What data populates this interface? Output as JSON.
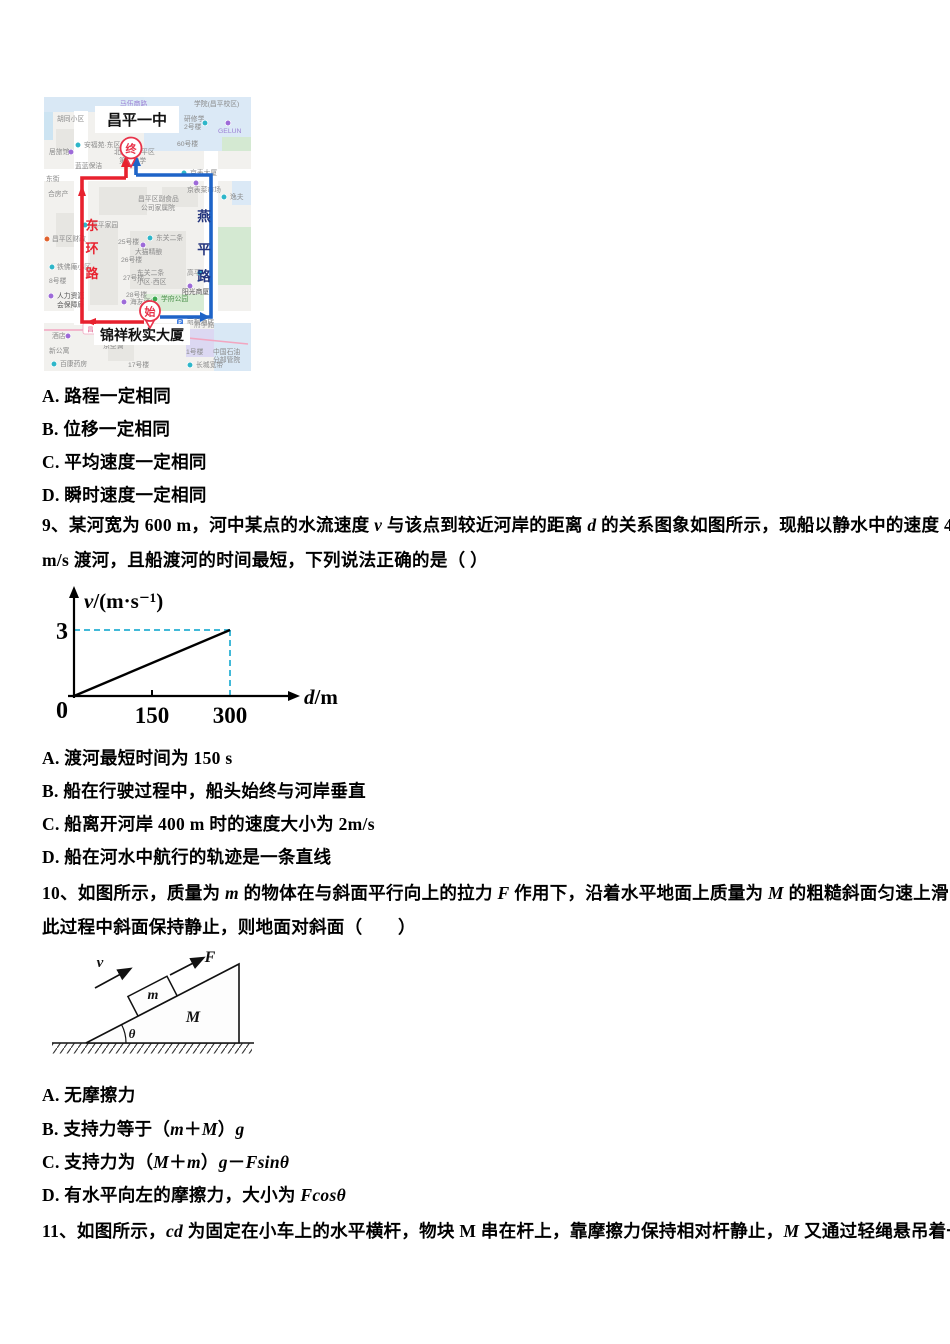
{
  "q8": {
    "options": [
      "A. 路程一定相同",
      "B. 位移一定相同",
      "C. 平均速度一定相同",
      "D. 瞬时速度一定相同"
    ]
  },
  "q9": {
    "stem": [
      [
        {
          "t": "9、某河宽为 600 m，河中某点的水流速度 "
        },
        {
          "t": "v",
          "i": true
        },
        {
          "t": " 与该点到较近河岸的距离 "
        },
        {
          "t": "d",
          "i": true
        },
        {
          "t": " 的关系图象如图所示，现船以静水中的速度 4"
        }
      ],
      [
        {
          "t": "m/s 渡河，且船渡河的时间最短，下列说法正确的是（ ）"
        }
      ]
    ],
    "options": [
      "A. 渡河最短时间为 150 s",
      "B. 船在行驶过程中，船头始终与河岸垂直",
      "C. 船离开河岸 400 m 时的速度大小为 2m/s",
      "D. 船在河水中航行的轨迹是一条直线"
    ]
  },
  "chart_data": {
    "type": "line",
    "title": "",
    "xlabel": "d/m",
    "ylabel": "v/(m·s⁻¹)",
    "xlabel_var": "d",
    "xlabel_rest": "/m",
    "ylabel_var": "v",
    "ylabel_rest": "/(m·s⁻¹)",
    "x": [
      0,
      300
    ],
    "y": [
      0,
      3
    ],
    "xticks": [
      150,
      300
    ],
    "yticks": [
      3
    ],
    "origin_label": "0",
    "xlim": [
      0,
      330
    ],
    "ylim": [
      0,
      3.6
    ],
    "dashed_guides": {
      "y": 3,
      "x": 300
    },
    "line_color": "#000000",
    "guide_color": "#41b9d8",
    "legend": [],
    "grid": false
  },
  "q10": {
    "stem": [
      [
        {
          "t": "10、如图所示，质量为 "
        },
        {
          "t": "m",
          "i": true
        },
        {
          "t": " 的物体在与斜面平行向上的拉力 "
        },
        {
          "t": "F",
          "i": true
        },
        {
          "t": " 作用下，沿着水平地面上质量为 "
        },
        {
          "t": "M",
          "i": true
        },
        {
          "t": " 的粗糙斜面匀速上滑，在"
        }
      ],
      [
        {
          "t": "此过程中斜面保持静止，则地面对斜面（　　）"
        }
      ]
    ],
    "options": [
      [
        {
          "t": "A. 无摩擦力"
        }
      ],
      [
        {
          "t": "B. 支持力等于（"
        },
        {
          "t": "m",
          "i": true
        },
        {
          "t": "＋"
        },
        {
          "t": "M",
          "i": true
        },
        {
          "t": "）"
        },
        {
          "t": "g",
          "i": true
        }
      ],
      [
        {
          "t": "C. 支持力为（"
        },
        {
          "t": "M",
          "i": true
        },
        {
          "t": "＋"
        },
        {
          "t": "m",
          "i": true
        },
        {
          "t": "）"
        },
        {
          "t": "g",
          "i": true
        },
        {
          "t": "－"
        },
        {
          "t": "Fsinθ",
          "i": true
        }
      ],
      [
        {
          "t": "D. 有水平向左的摩擦力，大小为 "
        },
        {
          "t": "Fcosθ",
          "i": true
        }
      ]
    ]
  },
  "figure10": {
    "v": "v",
    "F": "F",
    "m": "m",
    "M": "M",
    "theta": "θ"
  },
  "q11": {
    "stem": [
      [
        {
          "t": "11、如图所示，"
        },
        {
          "t": "cd",
          "i": true
        },
        {
          "t": " 为固定在小车上的水平横杆，物块 M 串在杆上，靠摩擦力保持相对杆静止，"
        },
        {
          "t": "M",
          "i": true
        },
        {
          "t": " 又通过轻绳悬吊着一个"
        }
      ]
    ]
  },
  "map": {
    "red": "#e8212e",
    "blue": "#1e64c8",
    "street_blue_color": "#24357d",
    "marker_end": "终",
    "marker_start": "始",
    "school_label": "昌平一中",
    "building_label": "锦祥秋实大厦",
    "metro_label": "昌平线",
    "street_red_chars": [
      "东",
      "环",
      "路"
    ],
    "street_blue_chars": [
      "燕",
      "平",
      "路"
    ],
    "pois": [
      {
        "t": "马伍商路",
        "x": 76,
        "y": 9,
        "c": "#9b7fd4"
      },
      {
        "t": "学院(昌平校区)",
        "x": 150,
        "y": 9
      },
      {
        "t": "胡同小区",
        "x": 13,
        "y": 24
      },
      {
        "t": "研修学",
        "x": 140,
        "y": 24,
        "ic": "teal",
        "ix": 161,
        "iy": 26
      },
      {
        "t": "2号楼",
        "x": 140,
        "y": 32
      },
      {
        "t": "GELUN",
        "x": 174,
        "y": 36,
        "c": "#9b7fd4",
        "ic": "purple",
        "ix": 184,
        "iy": 26
      },
      {
        "t": "安福苑·东区",
        "x": 40,
        "y": 50,
        "ic": "teal",
        "ix": 34,
        "iy": 48
      },
      {
        "t": "居旅馆",
        "x": 5,
        "y": 57,
        "ic": "purple",
        "ix": 27,
        "iy": 55
      },
      {
        "t": "60号楼",
        "x": 133,
        "y": 49
      },
      {
        "t": "北京市昌平区",
        "x": 70,
        "y": 57
      },
      {
        "t": "第一中学",
        "x": 75,
        "y": 66
      },
      {
        "t": "蓝蓝保洁",
        "x": 31,
        "y": 71
      },
      {
        "t": "东街",
        "x": 2,
        "y": 84
      },
      {
        "t": "京表大厦",
        "x": 146,
        "y": 78,
        "ic": "teal",
        "ix": 140,
        "iy": 76
      },
      {
        "t": "合房产",
        "x": 4,
        "y": 99
      },
      {
        "t": "京表菜市场",
        "x": 143,
        "y": 95,
        "ic": "purple",
        "ix": 152,
        "iy": 86
      },
      {
        "t": "逸夫",
        "x": 186,
        "y": 102,
        "ic": "teal",
        "ix": 180,
        "iy": 100
      },
      {
        "t": "昌平区副食品",
        "x": 94,
        "y": 104
      },
      {
        "t": "公司家属院",
        "x": 97,
        "y": 113
      },
      {
        "t": "高平家园",
        "x": 47,
        "y": 130,
        "ic": "teal",
        "ix": 41,
        "iy": 128
      },
      {
        "t": "25号楼",
        "x": 74,
        "y": 147
      },
      {
        "t": "东关二条",
        "x": 112,
        "y": 143,
        "ic": "teal",
        "ix": 106,
        "iy": 141
      },
      {
        "t": "昌平区财政",
        "x": 8,
        "y": 144,
        "ic": "orange",
        "ix": 3,
        "iy": 142
      },
      {
        "t": "大猫精酿",
        "x": 91,
        "y": 157,
        "ic": "purple",
        "ix": 99,
        "iy": 148
      },
      {
        "t": "26号楼",
        "x": 77,
        "y": 165
      },
      {
        "t": "铁佛庵小区",
        "x": 13,
        "y": 172,
        "ic": "teal",
        "ix": 8,
        "iy": 170
      },
      {
        "t": "东关二条",
        "x": 93,
        "y": 178
      },
      {
        "t": "小区·西区",
        "x": 93,
        "y": 187
      },
      {
        "t": "高平",
        "x": 143,
        "y": 178,
        "ic": "teal",
        "ix": 156,
        "iy": 176
      },
      {
        "t": "27号楼",
        "x": 79,
        "y": 183
      },
      {
        "t": "8号楼",
        "x": 5,
        "y": 186
      },
      {
        "t": "阳光商厦",
        "x": 138,
        "y": 197,
        "c": "#555555",
        "ic": "purple",
        "ix": 146,
        "iy": 189
      },
      {
        "t": "28号楼",
        "x": 82,
        "y": 200
      },
      {
        "t": "人力资源",
        "x": 13,
        "y": 201,
        "c": "#555555",
        "ic": "purple",
        "ix": 7,
        "iy": 199
      },
      {
        "t": "会保障局",
        "x": 13,
        "y": 210,
        "c": "#555555"
      },
      {
        "t": "海友酒店",
        "x": 86,
        "y": 207,
        "ic": "purple",
        "ix": 80,
        "iy": 205
      },
      {
        "t": "学府公园",
        "x": 117,
        "y": 204,
        "c": "#4a8f4a",
        "ic": "green",
        "ix": 111,
        "iy": 202
      },
      {
        "t": "府学路",
        "x": 150,
        "y": 230,
        "c": "#999999"
      },
      {
        "t": "丽枫酒店",
        "x": 143,
        "y": 227,
        "ic": "P",
        "ix": 136,
        "iy": 225
      },
      {
        "t": "酒店",
        "x": 8,
        "y": 241,
        "ic": "purple",
        "ix": 24,
        "iy": 239
      },
      {
        "t": "京空调",
        "x": 59,
        "y": 251,
        "ic": "blue",
        "ix": 65,
        "iy": 242
      },
      {
        "t": "新公寓",
        "x": 5,
        "y": 256
      },
      {
        "t": "1号楼",
        "x": 142,
        "y": 257
      },
      {
        "t": "中国石油",
        "x": 169,
        "y": 257
      },
      {
        "t": "分部管院",
        "x": 169,
        "y": 265
      },
      {
        "t": "百康药房",
        "x": 16,
        "y": 269,
        "ic": "teal",
        "ix": 10,
        "iy": 267
      },
      {
        "t": "长城宽带",
        "x": 152,
        "y": 270,
        "ic": "teal",
        "ix": 146,
        "iy": 268
      },
      {
        "t": "17号楼",
        "x": 84,
        "y": 270
      }
    ],
    "icon_colors": {
      "teal": "#2eb6c9",
      "purple": "#9d6ad8",
      "green": "#3aaa4f",
      "orange": "#e0622e",
      "blue": "#3f7de0",
      "P": "#3f7de0"
    }
  }
}
